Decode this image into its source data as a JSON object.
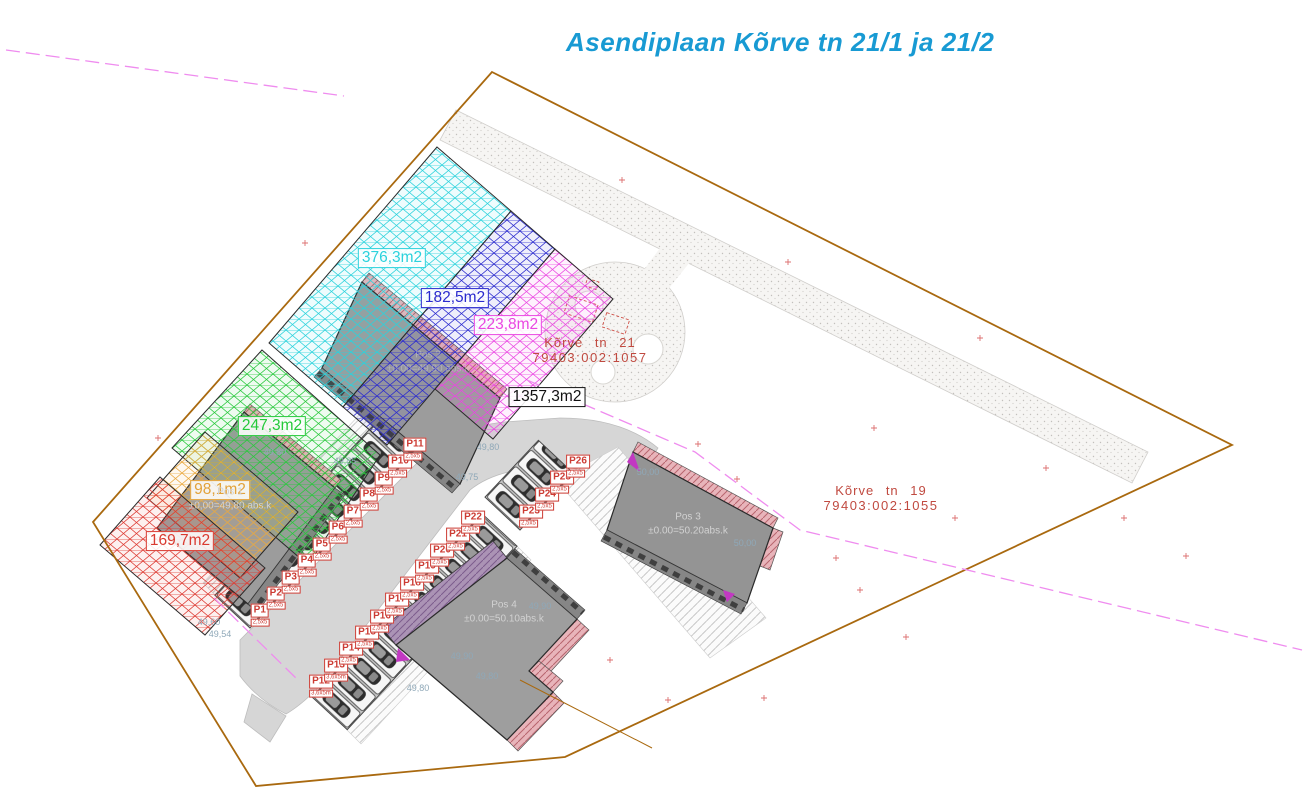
{
  "title": {
    "text": "Asendiplaan Kõrve tn 21/1 ja 21/2",
    "color": "#189ad3"
  },
  "parcels": [
    {
      "name": "Kõrve tn 21",
      "cadastre": "79403:002:1057",
      "x": 590,
      "y": 350
    },
    {
      "name": "Kõrve tn 19",
      "cadastre": "79403:002:1055",
      "x": 881,
      "y": 498
    }
  ],
  "area_labels": [
    {
      "text": "376,3m2",
      "color": "#2bd2dc",
      "x": 392,
      "y": 258
    },
    {
      "text": "182,5m2",
      "color": "#2a2ace",
      "x": 455,
      "y": 298
    },
    {
      "text": "223,8m2",
      "color": "#ea47e2",
      "x": 508,
      "y": 325
    },
    {
      "text": "1357,3m2",
      "color": "#111111",
      "x": 547,
      "y": 397
    },
    {
      "text": "247,3m2",
      "color": "#25c93a",
      "x": 272,
      "y": 426
    },
    {
      "text": "98,1m2",
      "color": "#e2a23a",
      "x": 220,
      "y": 490
    },
    {
      "text": "169,7m2",
      "color": "#d93a30",
      "x": 180,
      "y": 541
    }
  ],
  "buildings": [
    {
      "name": "Pos 1",
      "level": "±0,00=49,80 abs.k",
      "x": 230,
      "y": 499
    },
    {
      "name": "Pos 2",
      "level": "±0,00=49,90 abs.k",
      "x": 428,
      "y": 362,
      "faint": true
    },
    {
      "name": "Pos 3",
      "level": "±0.00=50.20abs.k",
      "x": 688,
      "y": 524
    },
    {
      "name": "Pos 4",
      "level": "±0.00=50.10abs.k",
      "x": 504,
      "y": 612
    }
  ],
  "parking": {
    "stalls": [
      {
        "label": "P1",
        "sub": "2,5x5",
        "x": 260,
        "y": 617
      },
      {
        "label": "P2",
        "sub": "2,5x5",
        "x": 276,
        "y": 600
      },
      {
        "label": "P3",
        "sub": "2,5x5",
        "x": 291,
        "y": 584
      },
      {
        "label": "P4",
        "sub": "2,5x5",
        "x": 307,
        "y": 567
      },
      {
        "label": "P5",
        "sub": "2,5x5",
        "x": 322,
        "y": 551
      },
      {
        "label": "P6",
        "sub": "2,5x5",
        "x": 338,
        "y": 534
      },
      {
        "label": "P7",
        "sub": "2,5x5",
        "x": 353,
        "y": 518
      },
      {
        "label": "P8",
        "sub": "2,5x5",
        "x": 369,
        "y": 501
      },
      {
        "label": "P9",
        "sub": "2,5x5",
        "x": 384,
        "y": 485
      },
      {
        "label": "P10",
        "sub": "2,5x5",
        "x": 400,
        "y": 468
      },
      {
        "label": "P11",
        "sub": "2,5x5",
        "x": 415,
        "y": 451
      },
      {
        "label": "P12",
        "sub": "3,6x5m",
        "x": 321,
        "y": 688
      },
      {
        "label": "P13",
        "sub": "3,6x5m",
        "x": 336,
        "y": 672
      },
      {
        "label": "P14",
        "sub": "2,5x5",
        "x": 351,
        "y": 655
      },
      {
        "label": "P15",
        "sub": "2,5x5",
        "x": 367,
        "y": 639
      },
      {
        "label": "P16",
        "sub": "2,5x5",
        "x": 382,
        "y": 623
      },
      {
        "label": "P17",
        "sub": "2,5x5",
        "x": 397,
        "y": 606
      },
      {
        "label": "P18",
        "sub": "2,5x5",
        "x": 412,
        "y": 590
      },
      {
        "label": "P19",
        "sub": "2,5x5",
        "x": 427,
        "y": 573
      },
      {
        "label": "P20",
        "sub": "2,5x5",
        "x": 442,
        "y": 557
      },
      {
        "label": "P21",
        "sub": "2,5x5",
        "x": 458,
        "y": 541
      },
      {
        "label": "P22",
        "sub": "2,5x5",
        "x": 473,
        "y": 524
      },
      {
        "label": "P23",
        "sub": "2,5x5",
        "x": 531,
        "y": 518
      },
      {
        "label": "P24",
        "sub": "2,5x5",
        "x": 547,
        "y": 501
      },
      {
        "label": "P25",
        "sub": "2,5x5",
        "x": 562,
        "y": 484
      },
      {
        "label": "P26",
        "sub": "2,5x5",
        "x": 578,
        "y": 468
      }
    ]
  },
  "elevations": [
    {
      "text": "49,85",
      "x": 345,
      "y": 461
    },
    {
      "text": "49,80",
      "x": 488,
      "y": 447
    },
    {
      "text": "49,75",
      "x": 467,
      "y": 477
    },
    {
      "text": "49,80",
      "x": 275,
      "y": 452
    },
    {
      "text": "50,00",
      "x": 648,
      "y": 472
    },
    {
      "text": "50,00",
      "x": 745,
      "y": 543
    },
    {
      "text": "49,90",
      "x": 540,
      "y": 606
    },
    {
      "text": "49,90",
      "x": 462,
      "y": 656
    },
    {
      "text": "49,80",
      "x": 487,
      "y": 676
    },
    {
      "text": "49,80",
      "x": 418,
      "y": 688
    },
    {
      "text": "49,60",
      "x": 209,
      "y": 622
    },
    {
      "text": "49,54",
      "x": 220,
      "y": 634
    }
  ],
  "colors": {
    "title_blue": "#189ad3",
    "boundary_orange": "#a9690f",
    "cadastral_red": "#c04a40",
    "parking_red": "#cc3b33",
    "elevation_gray_blue": "#8fa8b8",
    "utility_magenta": "#ef8cef",
    "building_gray": "#9c9c9c",
    "roof_pink": "#e8b4ba",
    "roof_purple": "#ab93b5"
  }
}
